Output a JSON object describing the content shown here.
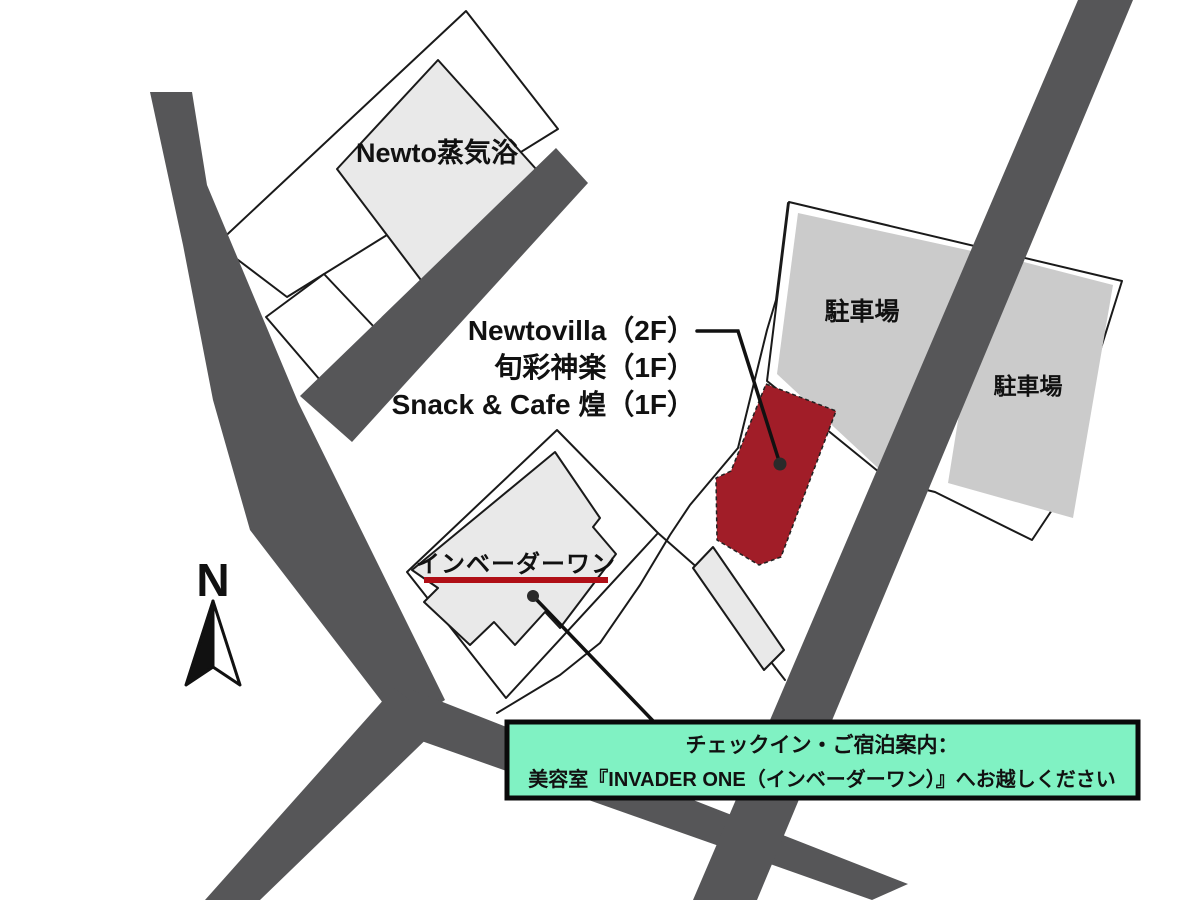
{
  "map": {
    "labels": {
      "building_top": "Newto蒸気浴",
      "parking_left": "駐車場",
      "parking_right": "駐車場",
      "salon": "インベーダーワン",
      "north": "N"
    },
    "tenant_lines": [
      "Newtovilla（2F）",
      "旬彩神楽（1F）",
      "Snack & Cafe 煌（1F）"
    ],
    "notice": {
      "line1": "チェックイン・ご宿泊案内：",
      "line2": "美容室『INVADER ONE（インベーダーワン）』へお越しください"
    },
    "colors": {
      "road": "#565658",
      "target_building": "#a11d28",
      "underline": "#b00f17",
      "notice_bg": "#80F2C3",
      "building_gray": "#e9e9e9",
      "parking_gray": "#cbcbcb",
      "outline": "#1a1a1a"
    }
  }
}
